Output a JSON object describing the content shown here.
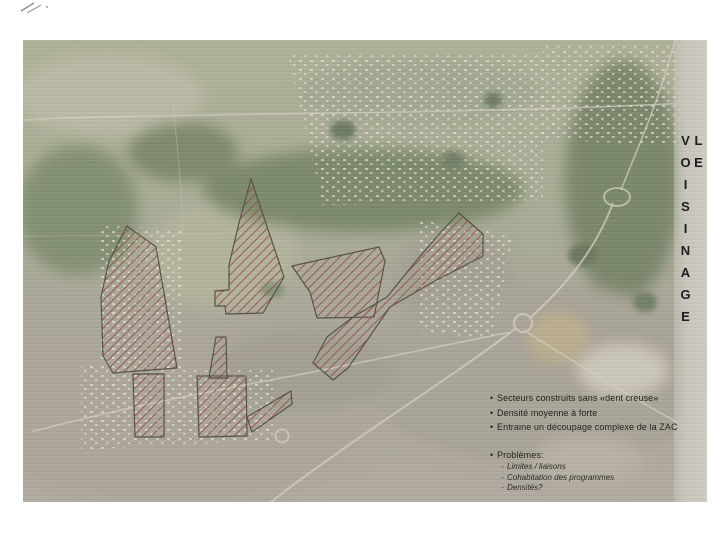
{
  "map": {
    "title_vertical": "LE VOISINAGE",
    "sectors": [
      "hatched-sector-left",
      "hatched-sector-upper-middle",
      "hatched-sector-middle",
      "hatched-sector-right-band",
      "hatched-sector-strip",
      "hatched-sector-bottom-center",
      "hatched-sector-bottom-left",
      "hatched-sector-bottom-small"
    ],
    "colors": {
      "hatch_red": "#8d3a2e",
      "sector_outline": "#454039",
      "photo_field_olive": "#b3b29d",
      "photo_woods_green": "#71805f",
      "photo_urban_gray": "#a19c90",
      "edge_strip": "#c8c5ba",
      "title_text": "#1d1d1d"
    }
  },
  "notes": {
    "bullet_marker": "•",
    "dash_marker": "-",
    "bullets": [
      "Secteurs construits sans «dent creuse»",
      "Densité moyenne à forte",
      "Entraine un découpage complexe de la ZAC"
    ],
    "problems_label": "Problèmes:",
    "problems": [
      "Limites / liaisons",
      "Cohabitation des programmes",
      "Densités?"
    ]
  }
}
